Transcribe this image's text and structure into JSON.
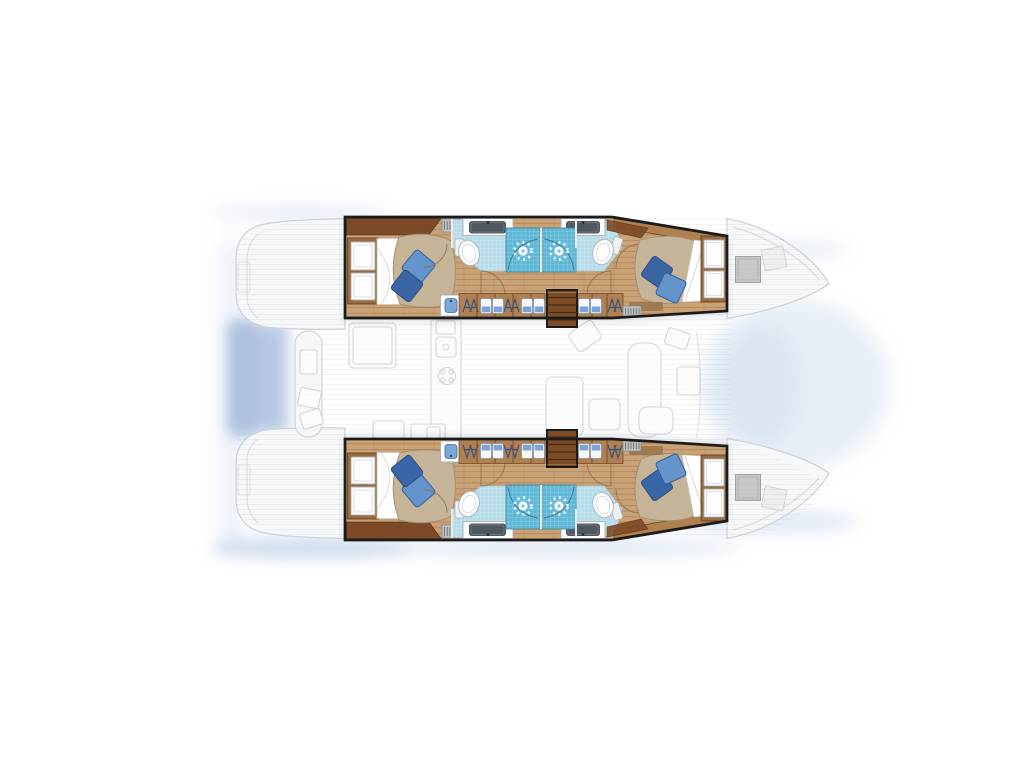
{
  "diagram": {
    "type": "yacht-floor-plan",
    "vessel": "sailing catamaran",
    "view": "top-down deck / accommodation plan",
    "orientation": "bow-right, stern-left",
    "highlight": "hull interiors shown in full colour; saloon, cockpits and decks faded grey",
    "counts": {
      "cabins": 4,
      "double_berths": 4,
      "bathrooms": 4,
      "showers": 4,
      "companionways": 2
    },
    "hulls": [
      {
        "id": "port-hull",
        "position": "top",
        "rooms": [
          {
            "name": "aft-cabin",
            "type": "cabin",
            "features": [
              "double-bed",
              "two-blue-pillows",
              "headboard-panels",
              "wardrobe-locker",
              "vent-grille",
              "washbasin-cabinet"
            ]
          },
          {
            "name": "aft-head",
            "type": "bathroom",
            "features": [
              "shower-cubicle",
              "toilet",
              "vanity-sink"
            ]
          },
          {
            "name": "forward-head",
            "type": "bathroom",
            "features": [
              "shower-cubicle",
              "toilet",
              "vanity-sink"
            ]
          },
          {
            "name": "companionway",
            "type": "stairs",
            "features": [
              "four-treads"
            ]
          },
          {
            "name": "forward-cabin",
            "type": "cabin",
            "features": [
              "double-bed",
              "two-blue-pillows",
              "headboard-panels",
              "hanging-wardrobe",
              "vent-grille",
              "rug"
            ]
          }
        ]
      },
      {
        "id": "starboard-hull",
        "position": "bottom",
        "rooms": [
          {
            "name": "aft-cabin",
            "type": "cabin",
            "features": [
              "double-bed",
              "two-blue-pillows",
              "headboard-panels",
              "wardrobe-locker",
              "vent-grille",
              "washbasin-cabinet"
            ]
          },
          {
            "name": "aft-head",
            "type": "bathroom",
            "features": [
              "shower-cubicle",
              "toilet",
              "vanity-sink"
            ]
          },
          {
            "name": "forward-head",
            "type": "bathroom",
            "features": [
              "shower-cubicle",
              "toilet",
              "vanity-sink"
            ]
          },
          {
            "name": "companionway",
            "type": "stairs",
            "features": [
              "four-treads"
            ]
          },
          {
            "name": "forward-cabin",
            "type": "cabin",
            "features": [
              "double-bed",
              "two-blue-pillows",
              "headboard-panels",
              "hanging-wardrobe",
              "vent-grille",
              "rug"
            ]
          }
        ]
      }
    ],
    "faded_areas": [
      "aft-cockpit-with-bench-and-table",
      "saloon-galley-with-sink-and-stove",
      "dining-table-and-sofa",
      "forward-cockpit-seats",
      "bow-decks-with-hatches",
      "stern-transoms"
    ],
    "icons": {
      "shower-rose-icon": "white starburst circle",
      "toilet-icon": "white oval bowl with cistern",
      "sink-icon": "dark grey rounded rectangle on white counter",
      "hanging-clothes-icon": "hanger A-glyph on rail",
      "folded-linen-icon": "white and blue stacked towels",
      "vent-grille-icon": "striped grey rectangle",
      "companionway-stairs-icon": "brown rectangle with treads",
      "deck-hatch-icon": "grey square on bow deck"
    }
  },
  "colors": {
    "background": "#ffffff",
    "outline": "#1b1b1b",
    "wood-floor": "#c9a276",
    "wood-dark": "#7c4a26",
    "wood-mid": "#b08050",
    "duvet": "#c6b498",
    "duvet-edge": "#a08b6e",
    "sheet": "#ffffff",
    "pillow-light": "#6593cc",
    "pillow-dark": "#3b66a6",
    "tile": "#b7dcea",
    "shower": "#5eb7d7",
    "fixture": "#fdfdfd",
    "sink-gray": "#4f585e",
    "faded-fill": "#f5f7f8",
    "faded-line": "#ccd3d8",
    "glow-strong": "#a9bede",
    "glow-soft": "#cfdcee",
    "hatch": "#c6c8ca"
  }
}
